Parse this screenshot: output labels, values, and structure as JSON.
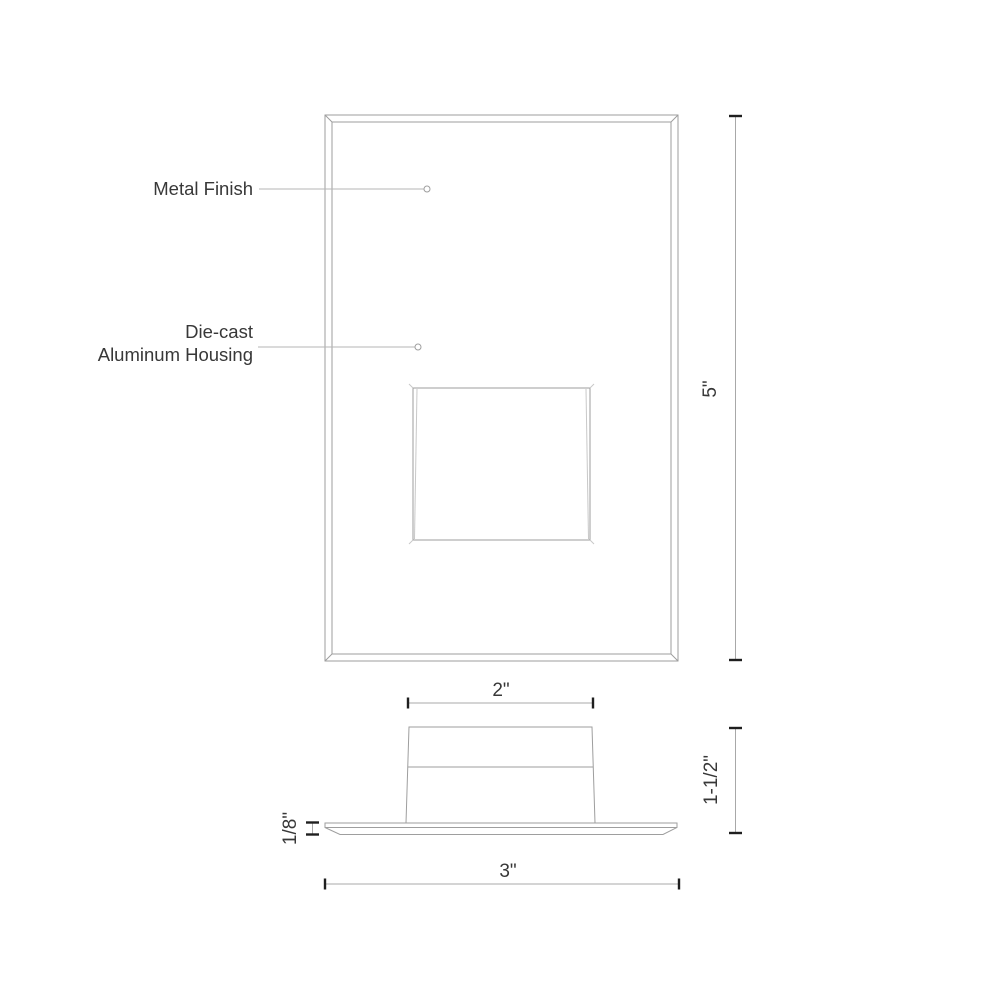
{
  "drawing": {
    "type": "technical-dimension-drawing",
    "views": {
      "front_view": "faceplate front view with lamp opening",
      "side_view": "housing profile on mounting plate"
    },
    "labels": {
      "metal_finish": "Metal Finish",
      "die_cast_line1": "Die-cast",
      "die_cast_line2": "Aluminum Housing"
    },
    "dimensions": {
      "front_height": "5\"",
      "housing_width": "2\"",
      "plate_width": "3\"",
      "side_height": "1-1/2\"",
      "plate_thickness": "1/8\""
    }
  },
  "colors": {
    "object_line": "#9e9e9e",
    "object_line_light": "#c8c8c8",
    "dimension_line": "#a8a8a8",
    "tick": "#1f1f1f",
    "text": "#383838",
    "leader": "#b5b5b5",
    "bg": "#ffffff"
  }
}
